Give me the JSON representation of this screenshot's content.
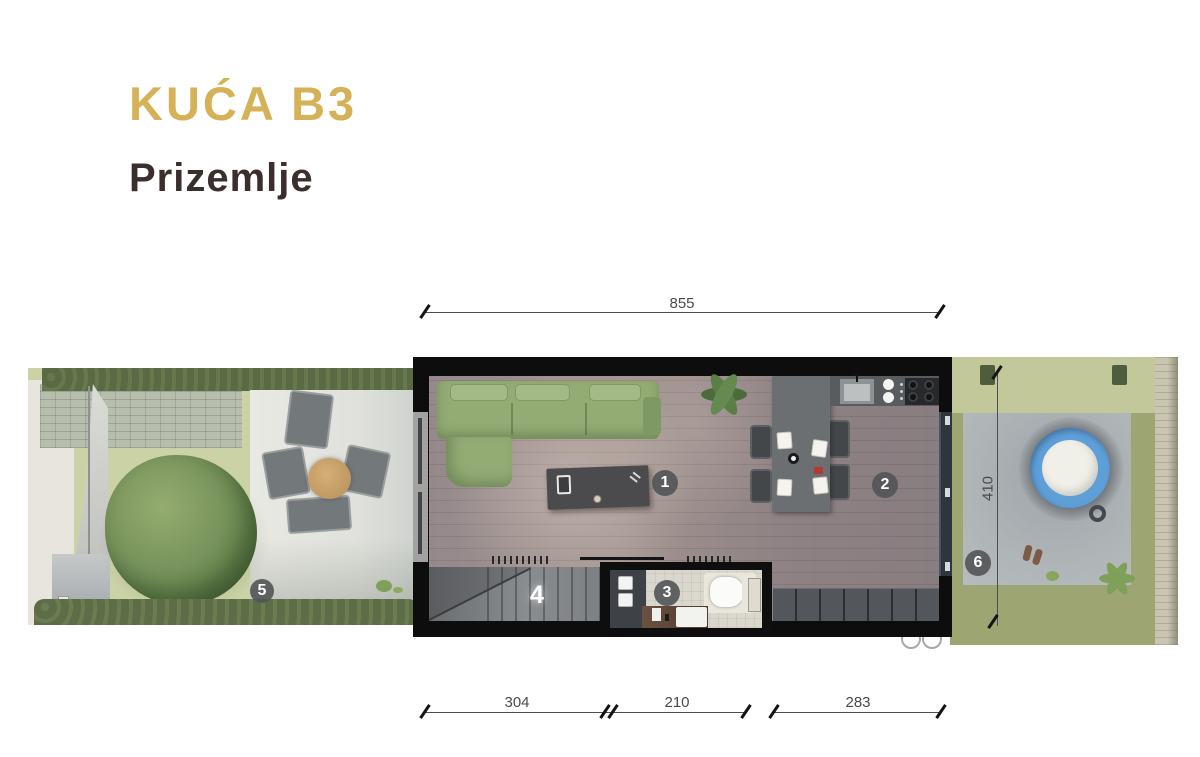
{
  "header": {
    "title": "KUĆA B3",
    "subtitle": "Prizemlje"
  },
  "dimensions": {
    "top": "855",
    "side": "410",
    "bottom": [
      "304",
      "210",
      "283"
    ]
  },
  "markers": [
    "1",
    "2",
    "3",
    "4",
    "5",
    "6"
  ],
  "colors": {
    "accent_gold": "#D5B258",
    "heading_dark": "#3A2F2D",
    "wall_black": "#0D0D0D",
    "sofa_green": "#93AC74",
    "pool_blue": "#5F9FD8",
    "marker_badge": "#525456",
    "dimension_gray": "#4A4A4A"
  }
}
